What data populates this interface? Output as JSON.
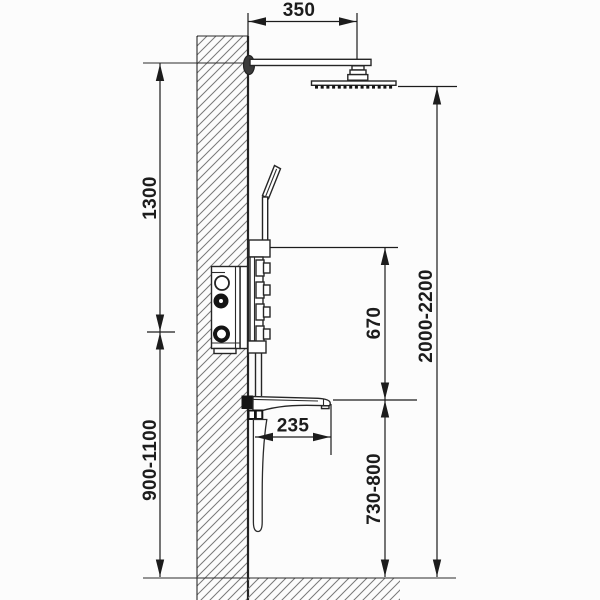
{
  "diagram": {
    "type": "shower-system-installation-drawing",
    "dimensions": {
      "head_offset_from_wall": "350",
      "arm_to_mixer_height": "1300",
      "mixer_mounting_height": "900-1100",
      "mixer_to_spout": "670",
      "overall_height": "2000-2200",
      "spout_reach": "235",
      "spout_mounting_height": "730-800"
    },
    "colors": {
      "line": "#262626",
      "dimension": "#1c1c1c",
      "hatch": "#787878",
      "background": "#fcfcfc"
    }
  }
}
